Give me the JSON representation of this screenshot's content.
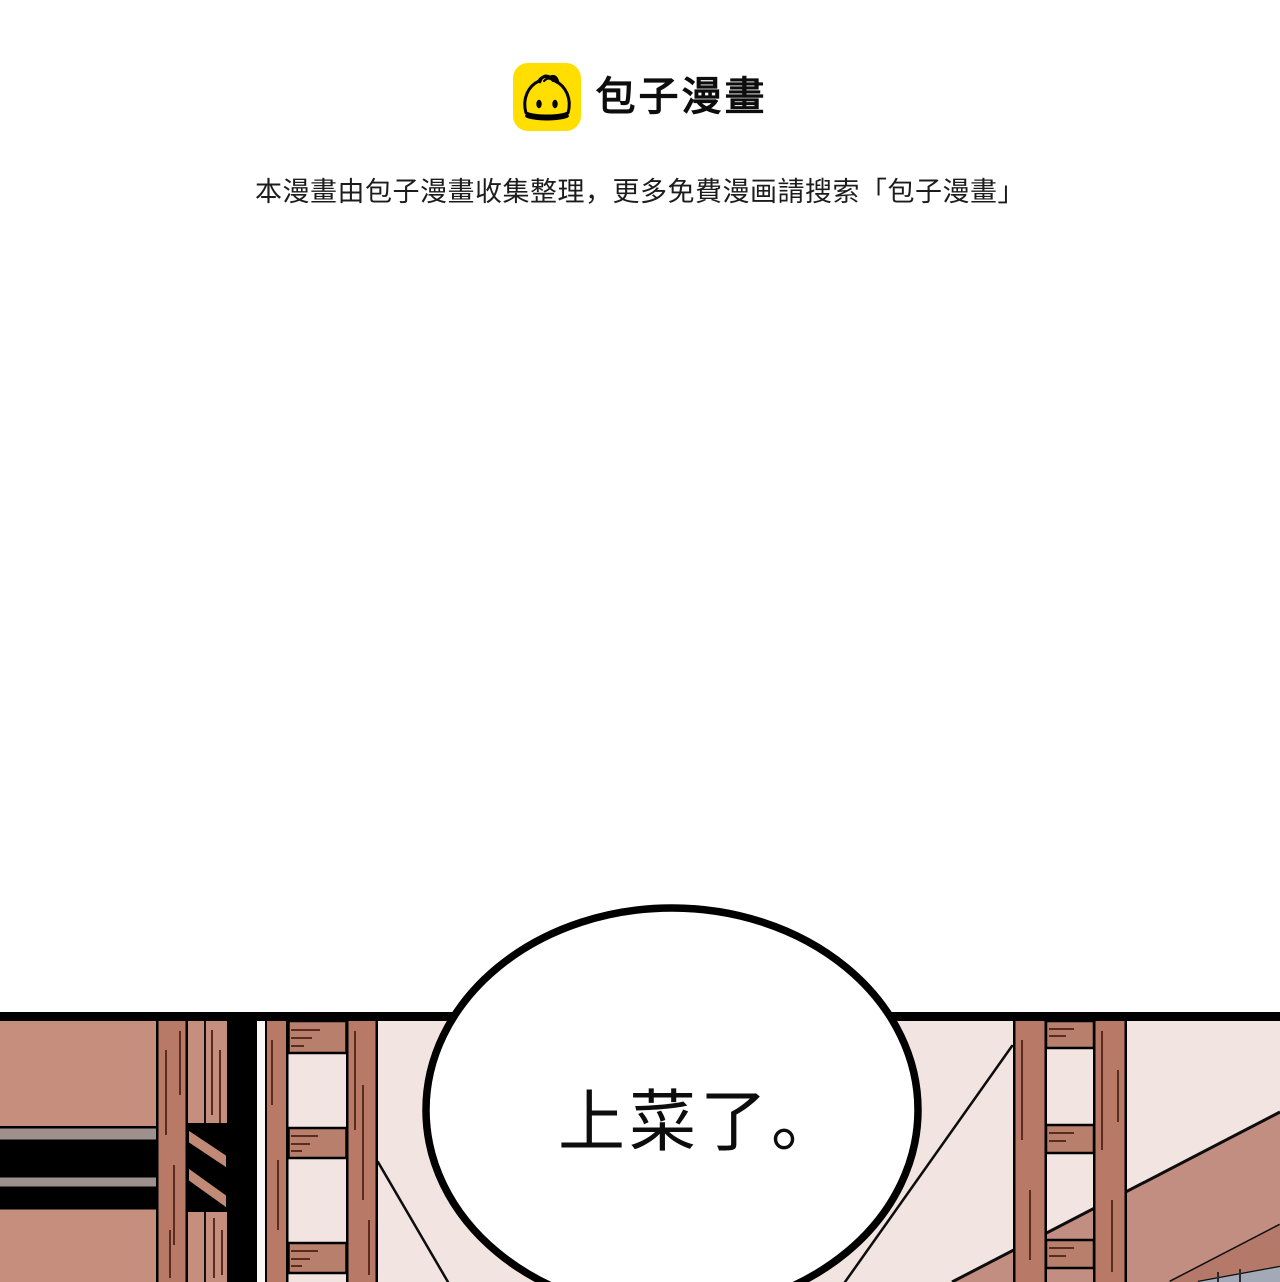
{
  "header": {
    "brand_icon": "baozi-bun-icon",
    "brand_color": "#FFDE00",
    "brand_name": "包子漫畫",
    "notice_text": "本漫畫由包子漫畫收集整理，更多免費漫画請搜索「包子漫畫」"
  },
  "panel": {
    "speech_bubble": {
      "text": "上菜了。"
    },
    "colors": {
      "wall": "#f2e5e1",
      "wood_light": "#c68f7d",
      "wood_dark": "#b87a67",
      "wood_rung": "#b8806c",
      "beam_face": "#c28e81",
      "beam_side": "#b5796a",
      "shelf_gray_strip": "#9e908d",
      "corner_blue_gray": "#a3a9b7",
      "outline": "#000000"
    }
  }
}
